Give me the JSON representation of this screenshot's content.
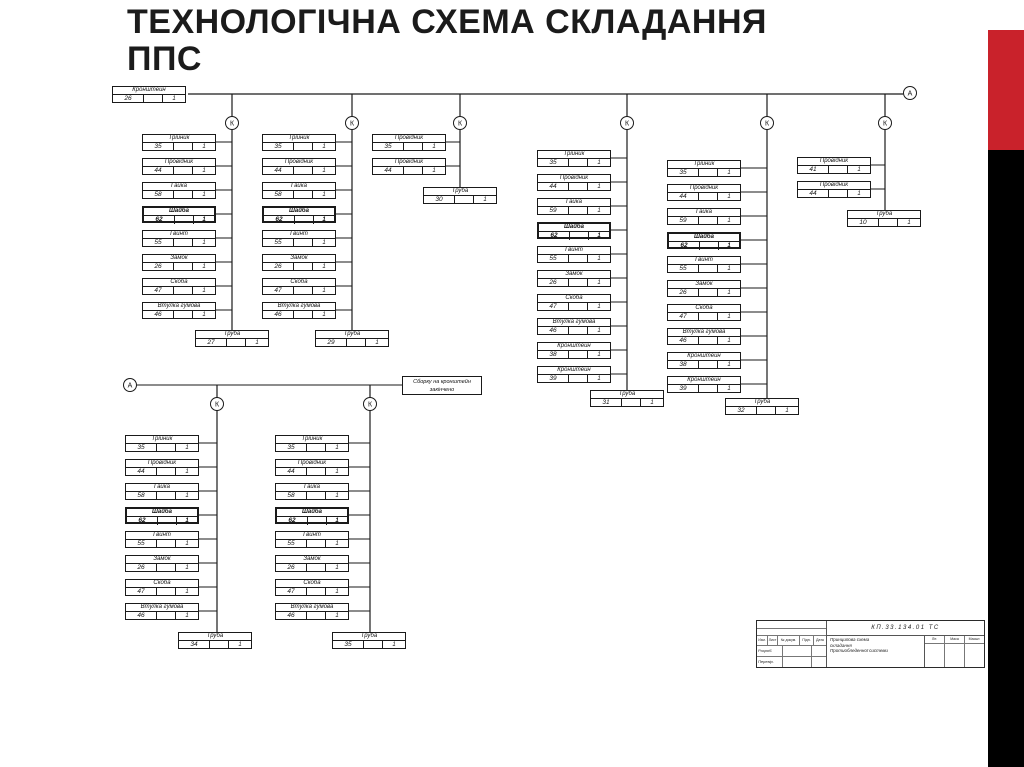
{
  "slide": {
    "title_line1": "ТЕХНОЛОГІЧНА СХЕМА СКЛАДАННЯ",
    "title_line2": "ППС",
    "accent_red": "#c9222b",
    "accent_black": "#000000"
  },
  "diagram": {
    "node_labels": {
      "assembly": "К",
      "final": "А"
    },
    "root_part": {
      "name": "Кронштейн",
      "num": "26",
      "qty": "1"
    },
    "note": {
      "line1": "Сборку на кронштейн",
      "line2": "закінчено"
    },
    "chains": [
      {
        "id": "top-1",
        "parts": [
          {
            "name": "Трійник",
            "num": "35",
            "qty": "1"
          },
          {
            "name": "Провідник",
            "num": "44",
            "qty": "1"
          },
          {
            "name": "Гайка",
            "num": "58",
            "qty": "1"
          },
          {
            "name": "Шайба",
            "num": "62",
            "qty": "1",
            "bold": true
          },
          {
            "name": "Гвинт",
            "num": "55",
            "qty": "1"
          },
          {
            "name": "Замок",
            "num": "26",
            "qty": "1"
          },
          {
            "name": "Скоба",
            "num": "47",
            "qty": "1"
          },
          {
            "name": "Втулка гумова",
            "num": "46",
            "qty": "1"
          }
        ],
        "end": {
          "name": "Труба",
          "num": "27",
          "qty": "1"
        }
      },
      {
        "id": "top-2",
        "parts": [
          {
            "name": "Трійник",
            "num": "35",
            "qty": "1"
          },
          {
            "name": "Провідник",
            "num": "44",
            "qty": "1"
          },
          {
            "name": "Гайка",
            "num": "58",
            "qty": "1"
          },
          {
            "name": "Шайба",
            "num": "62",
            "qty": "1",
            "bold": true
          },
          {
            "name": "Гвинт",
            "num": "55",
            "qty": "1"
          },
          {
            "name": "Замок",
            "num": "26",
            "qty": "1"
          },
          {
            "name": "Скоба",
            "num": "47",
            "qty": "1"
          },
          {
            "name": "Втулка гумова",
            "num": "46",
            "qty": "1"
          }
        ],
        "end": {
          "name": "Труба",
          "num": "29",
          "qty": "1"
        }
      },
      {
        "id": "top-3",
        "parts": [
          {
            "name": "Провідник",
            "num": "35",
            "qty": "1"
          },
          {
            "name": "Провідник",
            "num": "44",
            "qty": "1"
          }
        ],
        "end": {
          "name": "Труба",
          "num": "30",
          "qty": "1"
        }
      },
      {
        "id": "top-4",
        "parts": [
          {
            "name": "Трійник",
            "num": "35",
            "qty": "1"
          },
          {
            "name": "Провідник",
            "num": "44",
            "qty": "1"
          },
          {
            "name": "Гайка",
            "num": "59",
            "qty": "1"
          },
          {
            "name": "Шайба",
            "num": "62",
            "qty": "1",
            "bold": true
          },
          {
            "name": "Гвинт",
            "num": "55",
            "qty": "1"
          },
          {
            "name": "Замок",
            "num": "26",
            "qty": "1"
          },
          {
            "name": "Скоба",
            "num": "47",
            "qty": "1"
          },
          {
            "name": "Втулка гумова",
            "num": "46",
            "qty": "1"
          },
          {
            "name": "Кронштейн",
            "num": "38",
            "qty": "1"
          },
          {
            "name": "Кронштейн",
            "num": "39",
            "qty": "1"
          }
        ],
        "end": {
          "name": "Труба",
          "num": "31",
          "qty": "1"
        }
      },
      {
        "id": "top-5",
        "parts": [
          {
            "name": "Трійник",
            "num": "35",
            "qty": "1"
          },
          {
            "name": "Провідник",
            "num": "44",
            "qty": "1"
          },
          {
            "name": "Гайка",
            "num": "59",
            "qty": "1"
          },
          {
            "name": "Шайба",
            "num": "62",
            "qty": "1",
            "bold": true
          },
          {
            "name": "Гвинт",
            "num": "55",
            "qty": "1"
          },
          {
            "name": "Замок",
            "num": "26",
            "qty": "1"
          },
          {
            "name": "Скоба",
            "num": "47",
            "qty": "1"
          },
          {
            "name": "Втулка гумова",
            "num": "46",
            "qty": "1"
          },
          {
            "name": "Кронштейн",
            "num": "38",
            "qty": "1"
          },
          {
            "name": "Кронштейн",
            "num": "39",
            "qty": "1"
          }
        ],
        "end": {
          "name": "Труба",
          "num": "32",
          "qty": "1"
        }
      },
      {
        "id": "top-6",
        "parts": [
          {
            "name": "Провідник",
            "num": "41",
            "qty": "1"
          },
          {
            "name": "Провідник",
            "num": "44",
            "qty": "1"
          }
        ],
        "end": {
          "name": "Труба",
          "num": "10",
          "qty": "1"
        }
      },
      {
        "id": "low-1",
        "parts": [
          {
            "name": "Трійник",
            "num": "35",
            "qty": "1"
          },
          {
            "name": "Провідник",
            "num": "44",
            "qty": "1"
          },
          {
            "name": "Гайка",
            "num": "58",
            "qty": "1"
          },
          {
            "name": "Шайба",
            "num": "62",
            "qty": "1",
            "bold": true
          },
          {
            "name": "Гвинт",
            "num": "55",
            "qty": "1"
          },
          {
            "name": "Замок",
            "num": "26",
            "qty": "1"
          },
          {
            "name": "Скоба",
            "num": "47",
            "qty": "1"
          },
          {
            "name": "Втулка гумова",
            "num": "46",
            "qty": "1"
          }
        ],
        "end": {
          "name": "Труба",
          "num": "34",
          "qty": "1"
        }
      },
      {
        "id": "low-2",
        "parts": [
          {
            "name": "Трійник",
            "num": "35",
            "qty": "1"
          },
          {
            "name": "Провідник",
            "num": "44",
            "qty": "1"
          },
          {
            "name": "Гайка",
            "num": "58",
            "qty": "1"
          },
          {
            "name": "Шайба",
            "num": "62",
            "qty": "1",
            "bold": true
          },
          {
            "name": "Гвинт",
            "num": "55",
            "qty": "1"
          },
          {
            "name": "Замок",
            "num": "26",
            "qty": "1"
          },
          {
            "name": "Скоба",
            "num": "47",
            "qty": "1"
          },
          {
            "name": "Втулка гумова",
            "num": "46",
            "qty": "1"
          }
        ],
        "end": {
          "name": "Труба",
          "num": "35",
          "qty": "1"
        }
      }
    ]
  },
  "stamp": {
    "doc_number": "КП.33.134.01 ТС",
    "description": [
      "Принципова схема",
      "складання",
      "Протиобледенної системи"
    ],
    "header_cells": [
      "Изм.",
      "Лист",
      "№ докум.",
      "Підп.",
      "Дата"
    ],
    "row_labels": [
      "Розроб.",
      "Перевір."
    ],
    "grid_labels": [
      "Літ.",
      "Маса",
      "Масшт."
    ]
  }
}
